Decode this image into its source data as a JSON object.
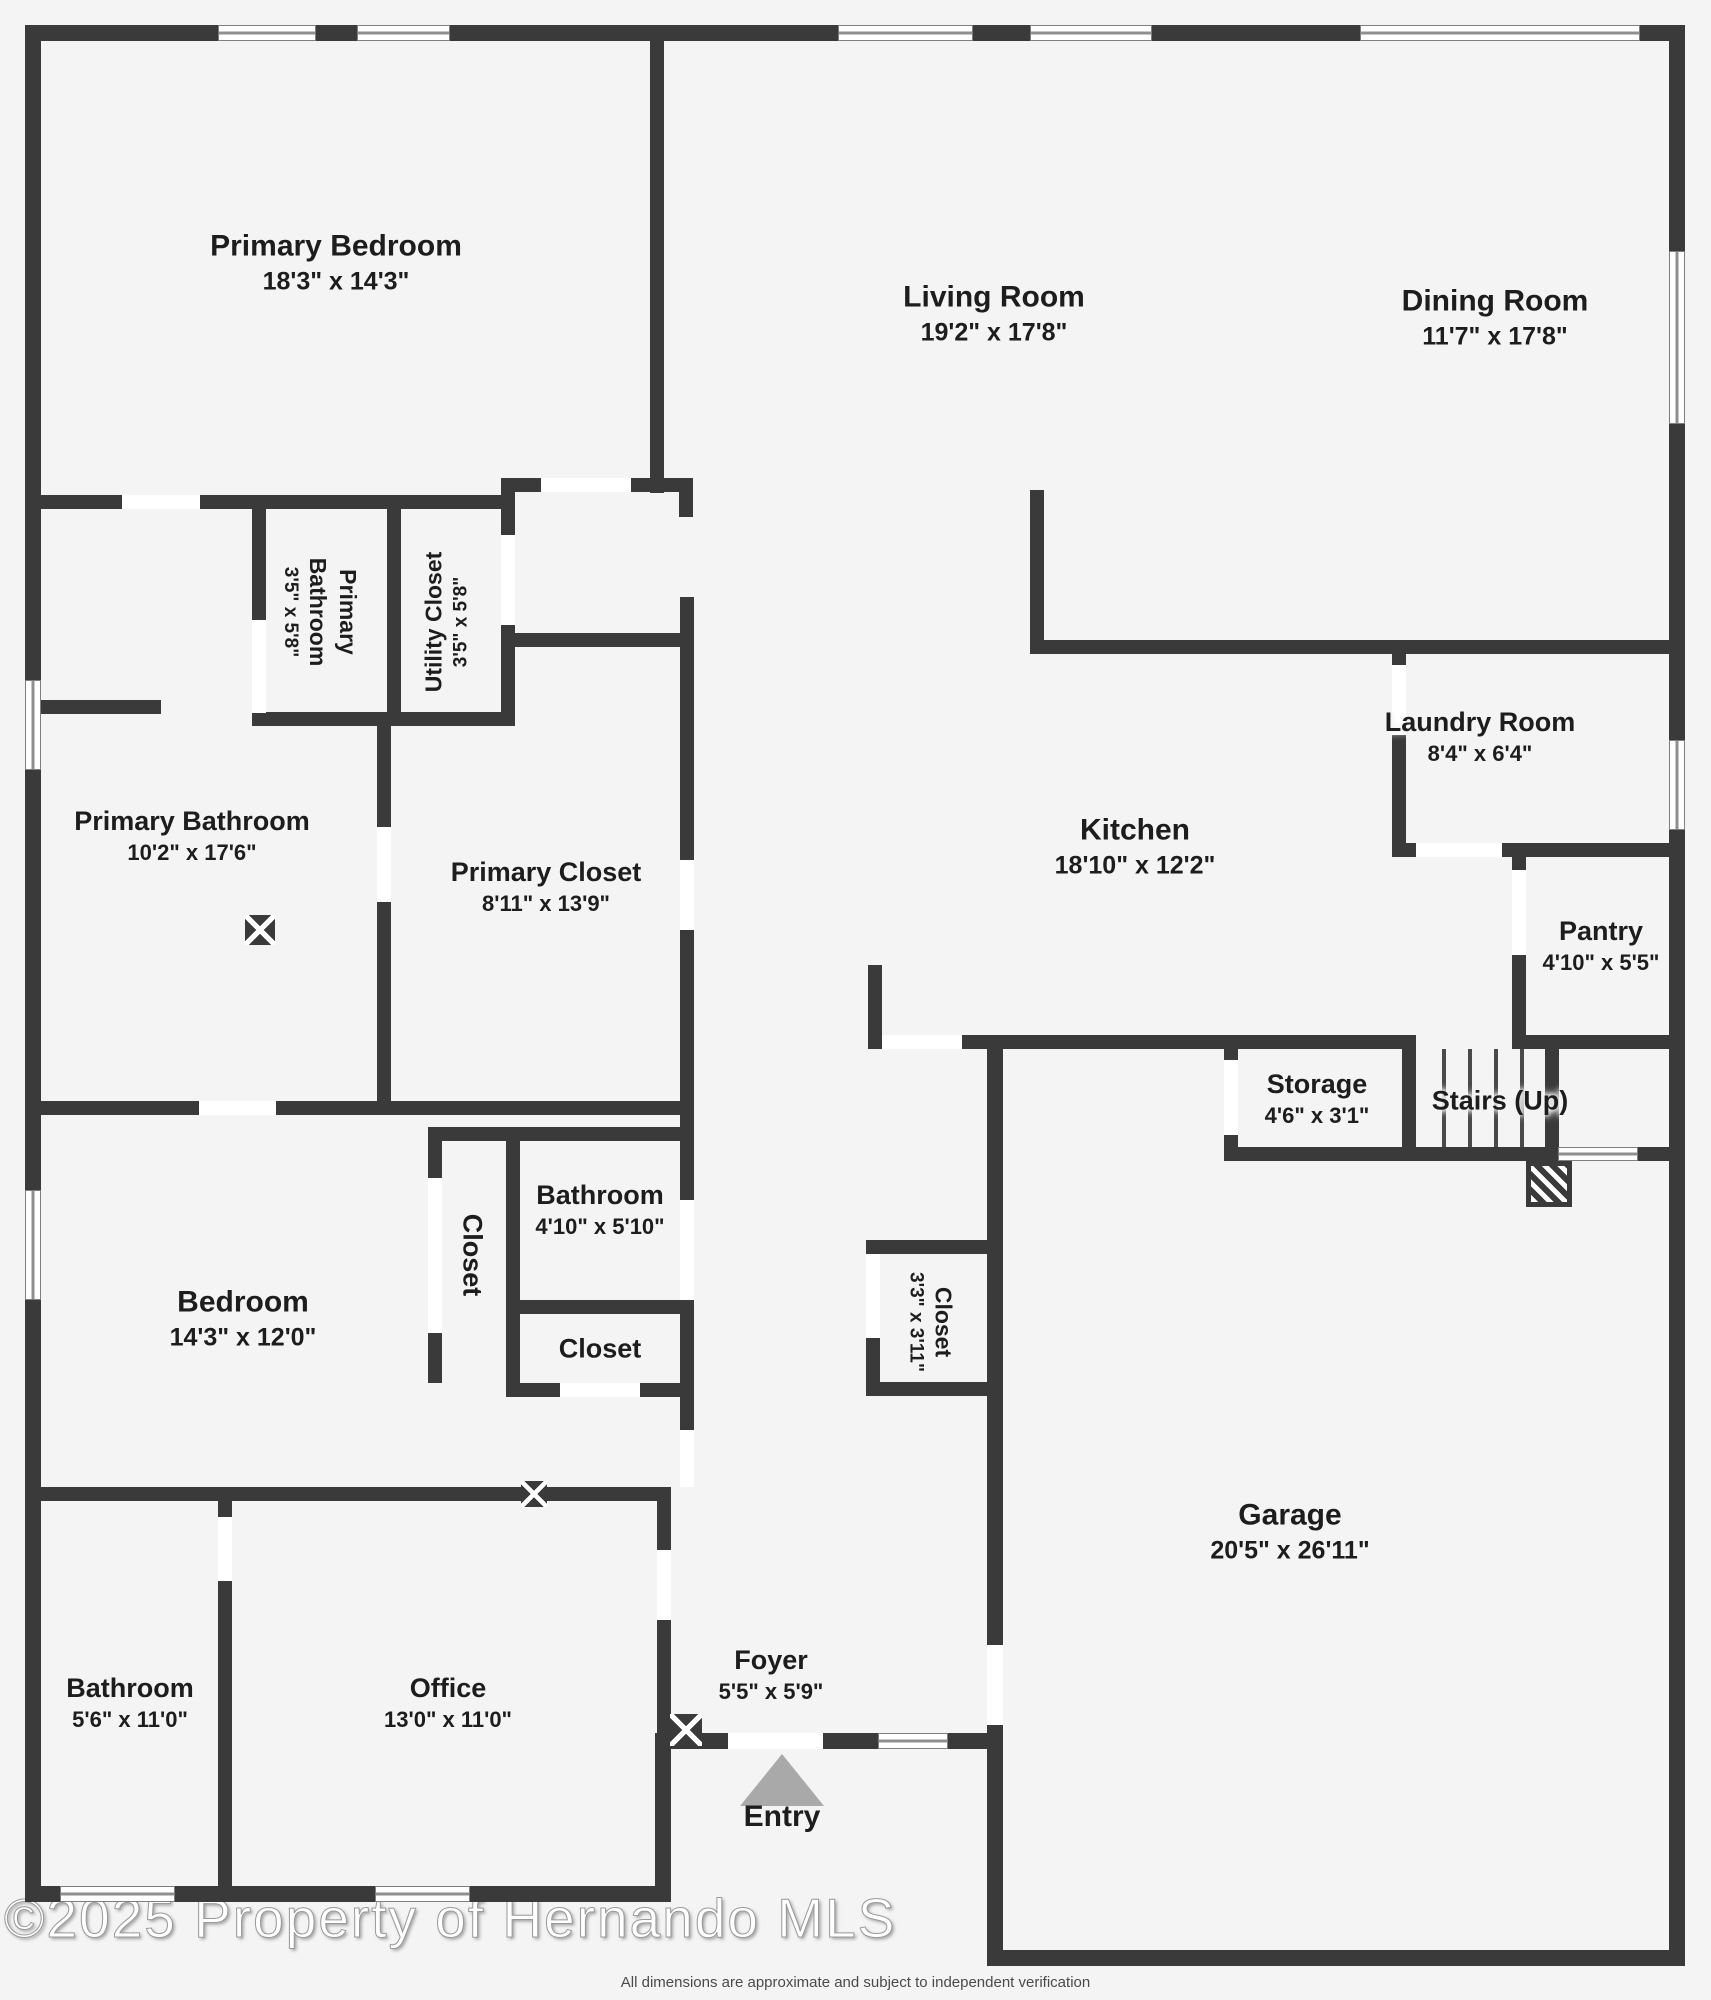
{
  "plan": {
    "title": "Floor plan",
    "colors": {
      "wall": "#3a3a3a",
      "background": "#f4f4f4",
      "window_line": "#8f8f8f",
      "entry_arrow": "#a9a9a9",
      "text": "#1d1d1d"
    },
    "rooms": [
      {
        "id": "primary-bedroom",
        "name": "Primary Bedroom",
        "dims": "18'3\" x 14'3\""
      },
      {
        "id": "living-room",
        "name": "Living Room",
        "dims": "19'2\" x 17'8\""
      },
      {
        "id": "dining-room",
        "name": "Dining Room",
        "dims": "11'7\" x 17'8\""
      },
      {
        "id": "primary-bathroom-small",
        "name": "Primary Bathroom",
        "dims": "3'5\" x 5'8\""
      },
      {
        "id": "utility-closet",
        "name": "Utility Closet",
        "dims": "3'5\" x 5'8\""
      },
      {
        "id": "primary-bathroom",
        "name": "Primary Bathroom",
        "dims": "10'2\" x 17'6\""
      },
      {
        "id": "primary-closet",
        "name": "Primary Closet",
        "dims": "8'11\" x 13'9\""
      },
      {
        "id": "laundry-room",
        "name": "Laundry Room",
        "dims": "8'4\" x 6'4\""
      },
      {
        "id": "kitchen",
        "name": "Kitchen",
        "dims": "18'10\" x 12'2\""
      },
      {
        "id": "pantry",
        "name": "Pantry",
        "dims": "4'10\" x 5'5\""
      },
      {
        "id": "storage",
        "name": "Storage",
        "dims": "4'6\" x 3'1\""
      },
      {
        "id": "stairs",
        "name": "Stairs (Up)",
        "dims": ""
      },
      {
        "id": "closet-bedroom",
        "name": "Closet",
        "dims": ""
      },
      {
        "id": "bathroom-hall",
        "name": "Bathroom",
        "dims": "4'10\" x 5'10\""
      },
      {
        "id": "closet-hall",
        "name": "Closet",
        "dims": ""
      },
      {
        "id": "bedroom",
        "name": "Bedroom",
        "dims": "14'3\" x 12'0\""
      },
      {
        "id": "closet-garage",
        "name": "Closet",
        "dims": "3'3\" x 3'11\""
      },
      {
        "id": "garage",
        "name": "Garage",
        "dims": "20'5\" x 26'11\""
      },
      {
        "id": "bathroom-front",
        "name": "Bathroom",
        "dims": "5'6\" x 11'0\""
      },
      {
        "id": "office",
        "name": "Office",
        "dims": "13'0\" x 11'0\""
      },
      {
        "id": "foyer",
        "name": "Foyer",
        "dims": "5'5\" x 5'9\""
      }
    ],
    "entry_label": "Entry",
    "watermark": "©2025 Property of Hernando MLS",
    "disclaimer": "All dimensions are approximate and subject to independent verification"
  }
}
